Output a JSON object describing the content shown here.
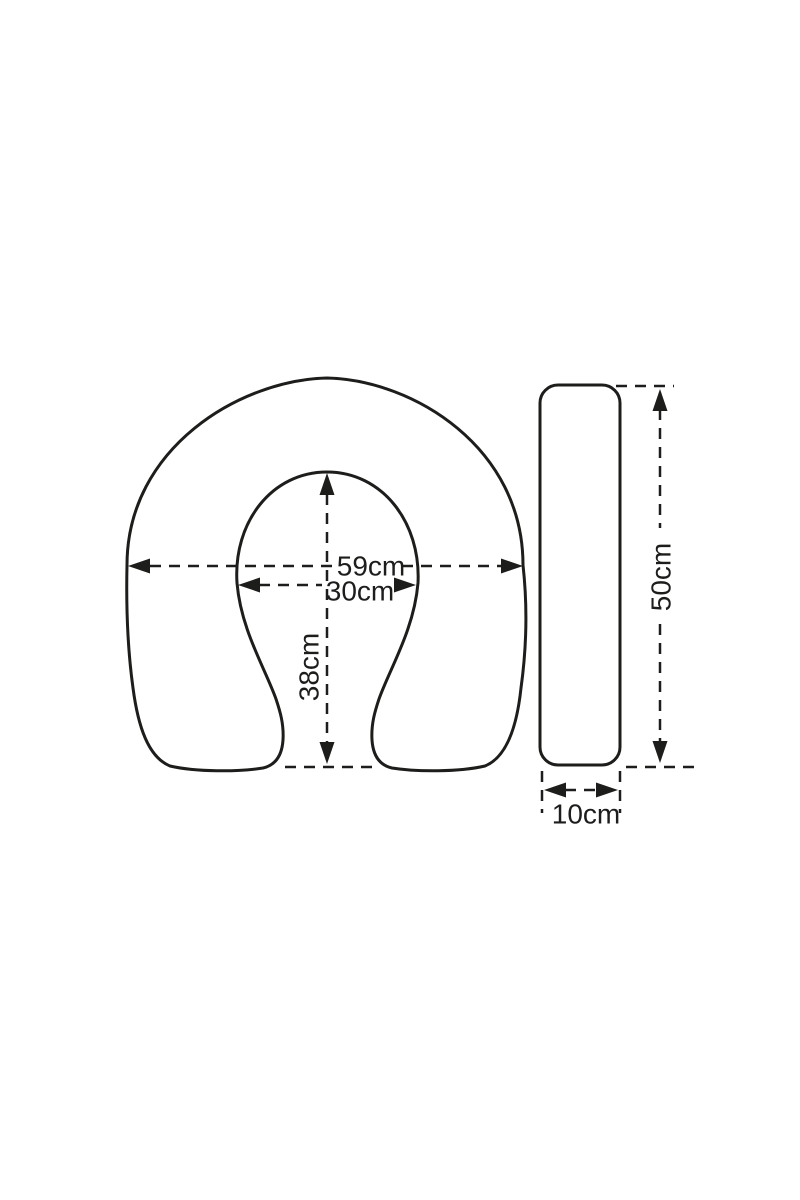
{
  "page": {
    "background_color": "#ffffff",
    "ink_color": "#1d1d1b"
  },
  "diagram": {
    "kind": "product-dimension-drawing",
    "front_view": {
      "shape": "horseshoe-cushion",
      "outer_width_label": "59cm",
      "inner_width_label": "30cm",
      "inner_depth_label": "38cm"
    },
    "side_view": {
      "shape": "rounded-slab-profile",
      "height_label": "50cm",
      "thickness_label": "10cm"
    }
  }
}
